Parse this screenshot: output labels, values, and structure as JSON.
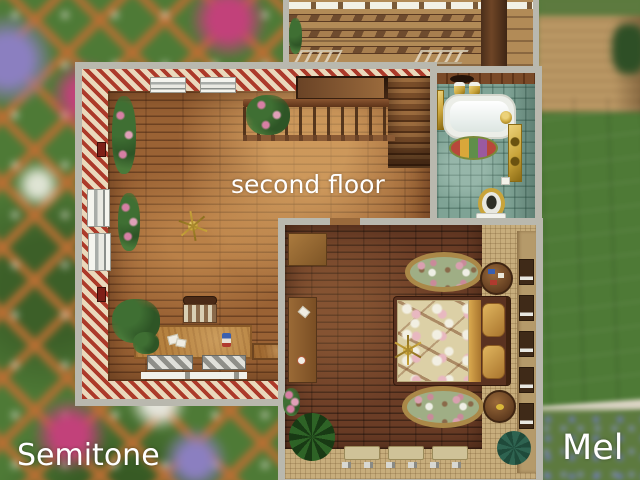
{
  "labels": {
    "floor_label": "second floor",
    "creator_label": "Semitone",
    "name_label": "Mel"
  },
  "palette": {
    "wall": "#b9b8ae",
    "stripe_red": "#ac3a2a",
    "stripe_cream": "#ead9bc",
    "wood": "#9a6234",
    "deck_wood": "#b28b57",
    "deck_beam": "#6e4b2e",
    "bath_tile": "#7fa395",
    "gold": "#c9a43a",
    "bed_wood": "#6b3d26",
    "tan_mat": "#c7ad7c",
    "blanket": "#dcd0a6",
    "rug_green": "#9fae85",
    "rug_trim": "#aa8848",
    "roof": "#948a7c",
    "grass": "#5d7a3f",
    "garden": "#4e7a36",
    "trellis": "#b96f33",
    "flower_pink": "#c2417a",
    "flower_purple": "#8b7fc0",
    "text": "#ffffff"
  },
  "scene": {
    "view": "top-down floor plan, second floor",
    "rooms": [
      {
        "name": "studio",
        "floor": "wood planks",
        "walls": "red-cream striped wallpaper",
        "objects": [
          "staircase",
          "stair-railing",
          "ceiling-fan",
          "desk",
          "desk-chair",
          "window-bench",
          "window-bench",
          "wall-window",
          "wall-window",
          "wall-window",
          "wall-window",
          "ivy-plant",
          "ivy-plant",
          "hanging-plant",
          "floor-plant",
          "corner-plant",
          "wall-vent",
          "wall-vent"
        ]
      },
      {
        "name": "bathroom",
        "floor": "teal mosaic tile",
        "objects": [
          "bathtub",
          "gold-faucet",
          "towel-rail",
          "perfume-bottles",
          "bath-rug",
          "wall-shelf",
          "toilet",
          "paper-holder"
        ]
      },
      {
        "name": "bedroom",
        "floor": "dark wood with woven mat border",
        "objects": [
          "double-bed",
          "floral-blanket",
          "pillows",
          "ceiling-fan",
          "oval-rug",
          "oval-rug",
          "round-table",
          "round-table",
          "cabinet",
          "dresser",
          "window-bench",
          "palm-plant",
          "succulent-plant",
          "wall-vine",
          "wall-windows"
        ]
      }
    ],
    "background": [
      "garden-trellis-with-flowers",
      "roof-deck",
      "shingle-roof",
      "grass-with-blue-flowers",
      "wooden-terrace"
    ]
  }
}
